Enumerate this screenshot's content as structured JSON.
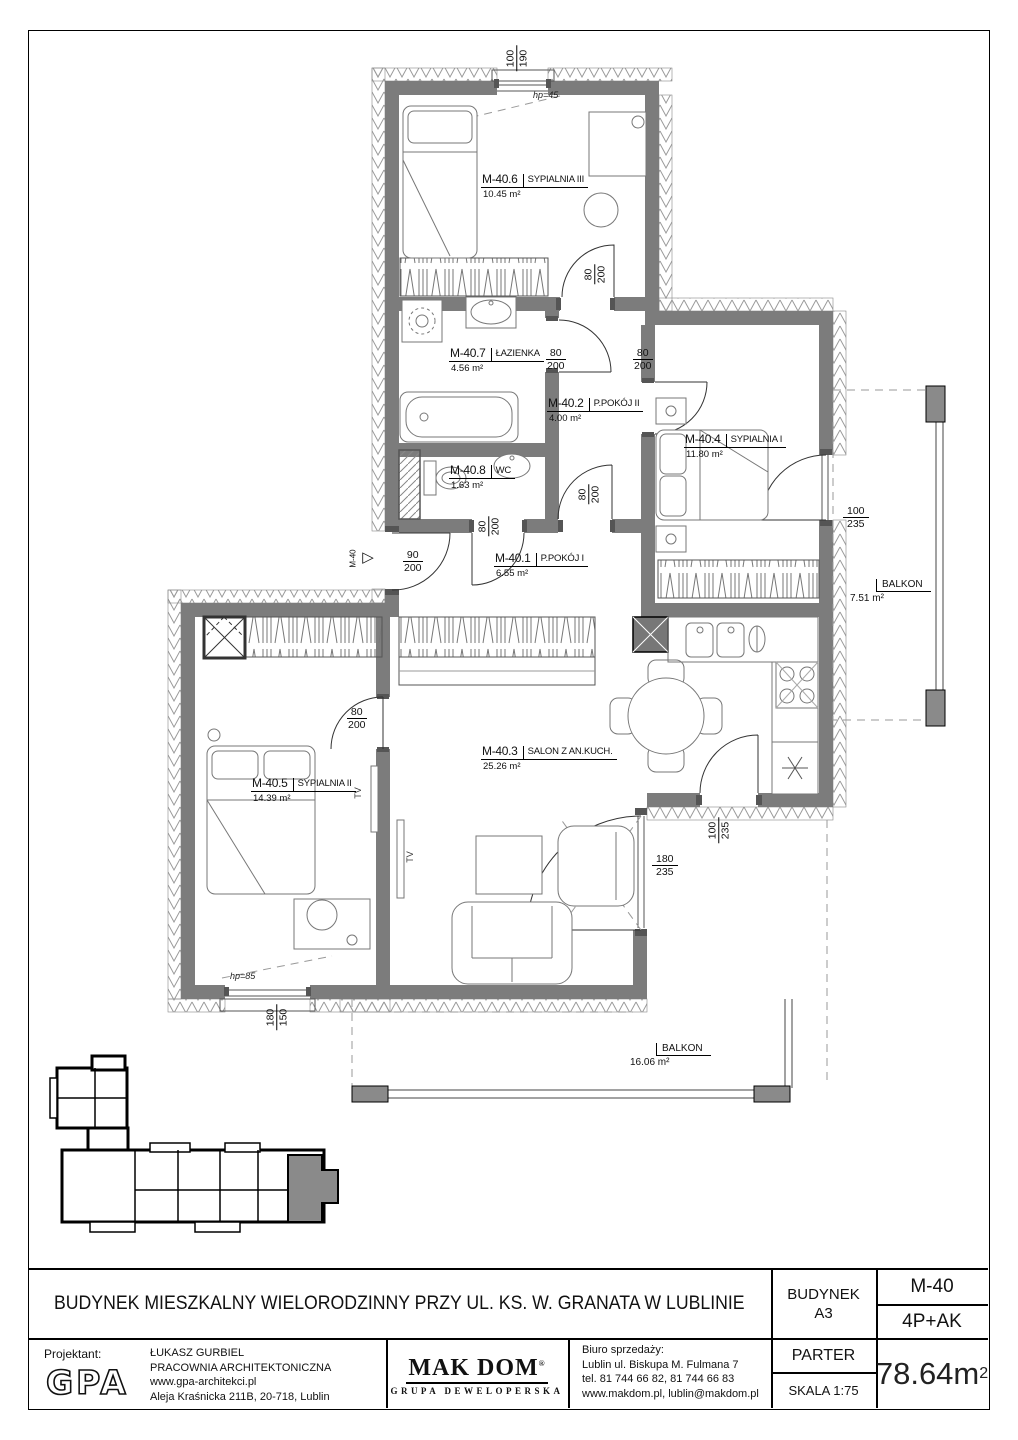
{
  "plan": {
    "rooms": [
      {
        "id": "M-40.6",
        "name": "SYPIALNIA III",
        "area": "10.45 m²"
      },
      {
        "id": "M-40.7",
        "name": "ŁAZIENKA",
        "area": "4.56 m²"
      },
      {
        "id": "M-40.2",
        "name": "P.POKÓJ II",
        "area": "4.00 m²"
      },
      {
        "id": "M-40.4",
        "name": "SYPIALNIA I",
        "area": "11.80 m²"
      },
      {
        "id": "M-40.8",
        "name": "WC",
        "area": "1.63 m²"
      },
      {
        "id": "M-40.1",
        "name": "P.POKÓJ I",
        "area": "6.55 m²"
      },
      {
        "id": "M-40.5",
        "name": "SYPIALNIA II",
        "area": "14.39 m²"
      },
      {
        "id": "M-40.3",
        "name": "SALON Z AN.KUCH.",
        "area": "25.26 m²"
      }
    ],
    "balconies": [
      {
        "name": "BALKON",
        "area": "7.51 m²"
      },
      {
        "name": "BALKON",
        "area": "16.06 m²"
      }
    ],
    "dims": [
      {
        "top": "100",
        "bottom": "190"
      },
      {
        "top": "80",
        "bottom": "200"
      },
      {
        "top": "80",
        "bottom": "200"
      },
      {
        "top": "80",
        "bottom": "200"
      },
      {
        "top": "80",
        "bottom": "200"
      },
      {
        "top": "80",
        "bottom": "200"
      },
      {
        "top": "90",
        "bottom": "200"
      },
      {
        "top": "80",
        "bottom": "200"
      },
      {
        "top": "100",
        "bottom": "235"
      },
      {
        "top": "100",
        "bottom": "235"
      },
      {
        "top": "180",
        "bottom": "235"
      },
      {
        "top": "180",
        "bottom": "150"
      }
    ],
    "window_heights": {
      "top": "hp=45",
      "bottom": "hp=85"
    },
    "entrance_label": "M-40",
    "tv_label": "TV"
  },
  "title_block": {
    "project_title": "BUDYNEK MIESZKALNY WIELORODZINNY PRZY UL. KS. W. GRANATA W LUBLINIE",
    "building_label": "BUDYNEK",
    "building_value": "A3",
    "unit_id": "M-40",
    "unit_type": "4P+AK",
    "floor": "PARTER",
    "scale": "SKALA 1:75",
    "area_value": "78.64m",
    "area_sup": "2",
    "designer_label": "Projektant:",
    "designer_logo": "GPA",
    "designer_name": "ŁUKASZ  GURBIEL",
    "designer_studio": "PRACOWNIA ARCHITEKTONICZNA",
    "designer_site": "www.gpa-architekci.pl",
    "designer_address": "Aleja Kraśnicka 211B, 20-718, Lublin",
    "makdom_logo": "MAK DOM",
    "makdom_reg": "®",
    "makdom_sub": "GRUPA DEWELOPERSKA",
    "sales_label": "Biuro sprzedaży:",
    "sales_address": "Lublin ul. Biskupa M. Fulmana 7",
    "sales_phone": "tel. 81 744 66 82, 81 744 66 83",
    "sales_web": "www.makdom.pl, lublin@makdom.pl"
  }
}
